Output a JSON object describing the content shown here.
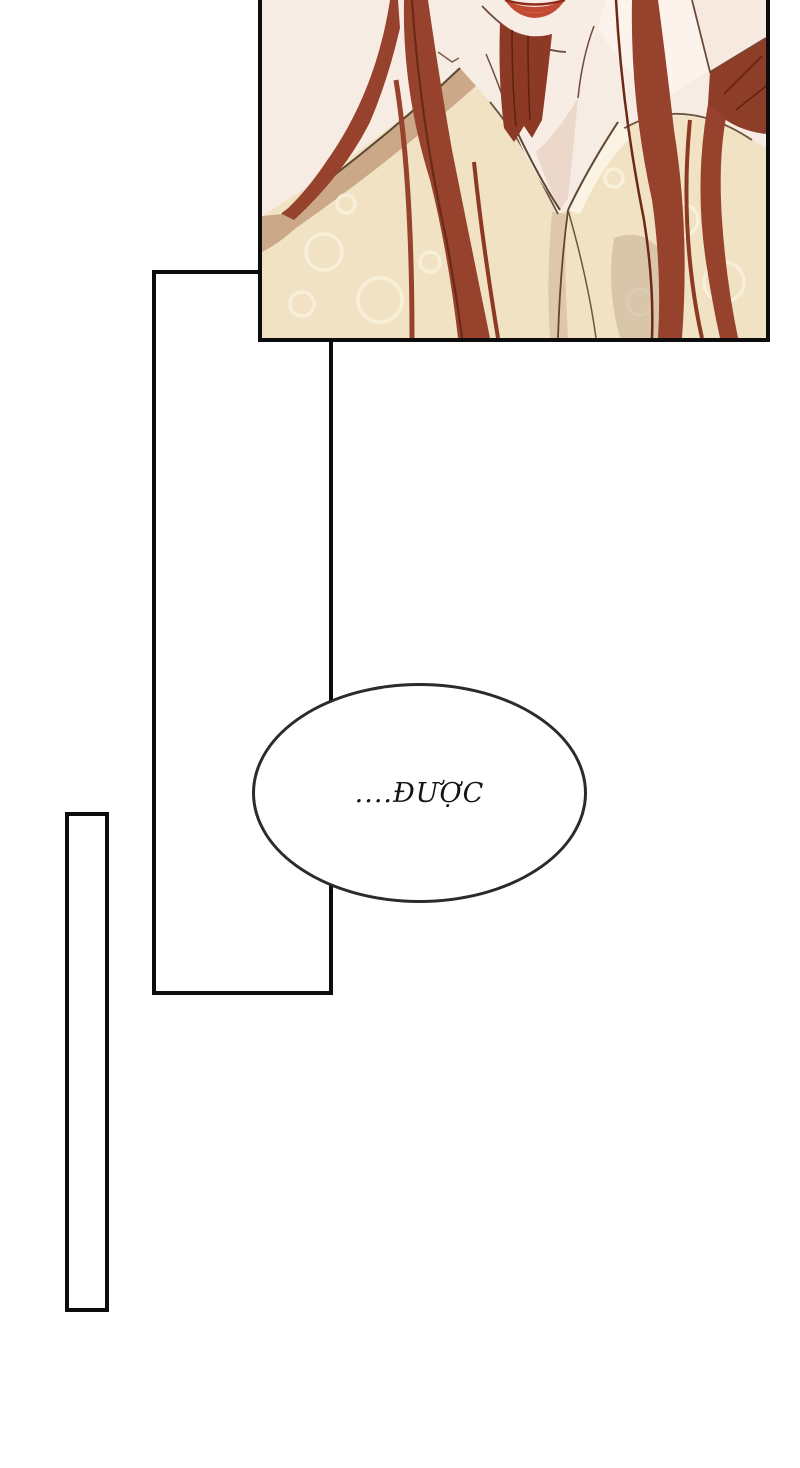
{
  "page": {
    "background": "#ffffff",
    "kind": "comic-page"
  },
  "speech_bubble": {
    "text": "....ĐƯỢC",
    "border_color": "#2b2b2b",
    "fill": "#ffffff"
  },
  "artwork": {
    "description": "close-up of a character with long auburn hair in a cream patterned robe, chin and lips visible at top",
    "colors": {
      "skin": "#f7ece4",
      "skin_bright": "#fbf3ec",
      "skin_shadow": "#ecd8ca",
      "hair": "#96422d",
      "hair_dark": "#6a2a16",
      "robe": "#f0e2c3",
      "robe_pattern": "#f9f0da",
      "robe_shadow": "#cba988",
      "soft_shadow": "#d9c2a3",
      "lips": "#c24a33",
      "outline": "#5f4733",
      "panel_border": "#0d0d0d"
    }
  }
}
